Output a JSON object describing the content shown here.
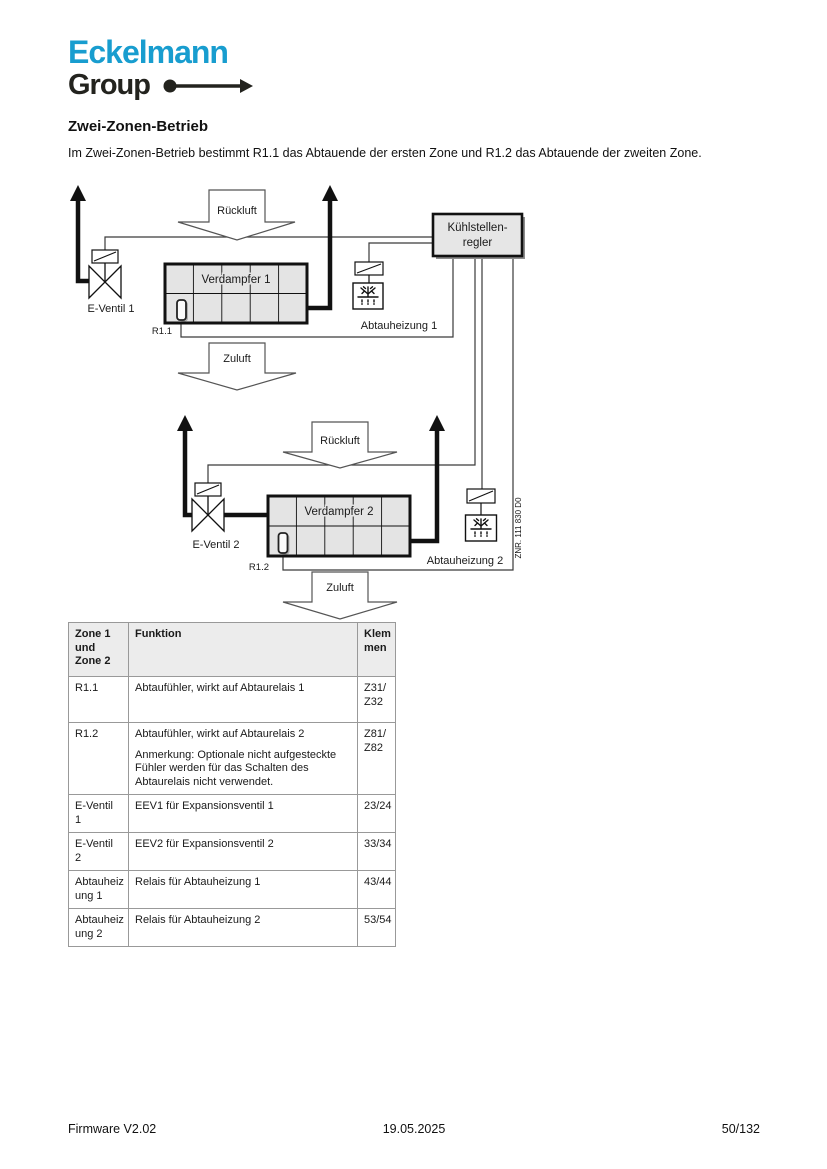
{
  "logo": {
    "line1": "Eckelmann",
    "line2": "Group",
    "brand_color": "#189dcf",
    "dark_color": "#23231e",
    "arrow_icon": "dot-long-arrow-right"
  },
  "heading": "Zwei-Zonen-Betrieb",
  "intro": "Im Zwei-Zonen-Betrieb bestimmt R1.1 das Abtauende der ersten Zone und R1.2 das Abtauende der zweiten Zone.",
  "diagram": {
    "controller": {
      "line1": "Kühlstellen-",
      "line2": "regler"
    },
    "zone1": {
      "return_air": "Rückluft",
      "supply_air": "Zuluft",
      "evaporator": "Verdampfer 1",
      "valve_label": "E-Ventil 1",
      "sensor_label": "R1.1",
      "heater_label": "Abtauheizung 1"
    },
    "zone2": {
      "return_air": "Rückluft",
      "supply_air": "Zuluft",
      "evaporator": "Verdampfer 2",
      "valve_label": "E-Ventil 2",
      "sensor_label": "R1.2",
      "heater_label": "Abtauheizung 2"
    },
    "drawing_number": "ZNR. 111 830 D0",
    "icons": {
      "valve": "bowtie-expansion-valve",
      "solenoid": "coil-box-with-diagonal",
      "defrost": "snowflake-with-melt-drops",
      "air_arrow": "block-arrow-down",
      "pipe_arrow": "solid-arrow-up"
    },
    "fill_color": "#e4e4e4"
  },
  "table": {
    "headers": {
      "col1": "Zone 1\nund\nZone 2",
      "col2": "Funktion",
      "col3": "Klem\nmen"
    },
    "rows": [
      {
        "zone": "R1.1",
        "funktion": "Abtaufühler, wirkt auf Abtaurelais 1",
        "note": "",
        "klemmen": "Z31/\nZ32"
      },
      {
        "zone": "R1.2",
        "funktion": "Abtaufühler, wirkt auf Abtaurelais 2",
        "note": "Anmerkung: Optionale nicht aufgesteckte Fühler werden für das Schalten des Abtaurelais nicht verwendet.",
        "klemmen": "Z81/\nZ82"
      },
      {
        "zone": "E-Ventil 1",
        "funktion": "EEV1 für Expansionsventil 1",
        "note": "",
        "klemmen": "23/24"
      },
      {
        "zone": "E-Ventil 2",
        "funktion": "EEV2 für Expansionsventil 2",
        "note": "",
        "klemmen": "33/34"
      },
      {
        "zone": "Abtauheiz\nung 1",
        "funktion": "Relais für Abtauheizung 1",
        "note": "",
        "klemmen": "43/44"
      },
      {
        "zone": "Abtauheiz\nung 2",
        "funktion": "Relais für Abtauheizung 2",
        "note": "",
        "klemmen": "53/54"
      }
    ]
  },
  "footer": {
    "left": "Firmware V2.02",
    "center": "19.05.2025",
    "right": "50/132"
  }
}
